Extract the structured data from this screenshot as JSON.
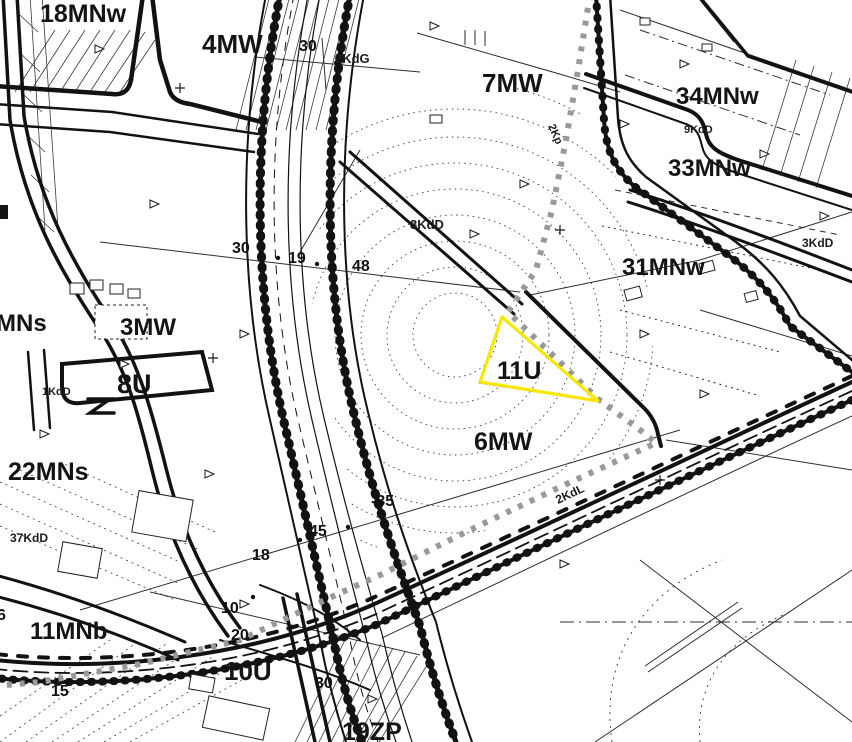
{
  "map": {
    "type": "zoning-plan-map",
    "colors": {
      "background": "#ffffff",
      "line_black": "#141414",
      "highlight_yellow": "#f8e800",
      "path_gray": "#999999"
    },
    "zone_labels": [
      {
        "text": "18MNw",
        "x": 40,
        "y": 22,
        "size": 25
      },
      {
        "text": "4MW",
        "x": 202,
        "y": 53,
        "size": 26
      },
      {
        "text": "7MW",
        "x": 482,
        "y": 92,
        "size": 26
      },
      {
        "text": "34MNw",
        "x": 676,
        "y": 104,
        "size": 24
      },
      {
        "text": "33MNw",
        "x": 668,
        "y": 176,
        "size": 24
      },
      {
        "text": "31MNw",
        "x": 622,
        "y": 275,
        "size": 24
      },
      {
        "text": "MNs",
        "x": -4,
        "y": 331,
        "size": 24
      },
      {
        "text": "3MW",
        "x": 120,
        "y": 335,
        "size": 24
      },
      {
        "text": "8U",
        "x": 117,
        "y": 393,
        "size": 27
      },
      {
        "text": "11U",
        "x": 497,
        "y": 379,
        "size": 25
      },
      {
        "text": "6MW",
        "x": 474,
        "y": 450,
        "size": 25
      },
      {
        "text": "22MNs",
        "x": 8,
        "y": 480,
        "size": 25
      },
      {
        "text": "11MNb",
        "x": 30,
        "y": 639,
        "size": 24
      },
      {
        "text": "10U",
        "x": 224,
        "y": 680,
        "size": 26
      },
      {
        "text": "19ZP",
        "x": 342,
        "y": 740,
        "size": 25
      }
    ],
    "road_labels": [
      {
        "text": "2KdG",
        "x": 335,
        "y": 63,
        "size": 13,
        "angle": 0
      },
      {
        "text": "2Kp",
        "x": 548,
        "y": 126,
        "size": 11,
        "angle": 66
      },
      {
        "text": "8KdD",
        "x": 410,
        "y": 229,
        "size": 13,
        "angle": 0
      },
      {
        "text": "9KdD",
        "x": 684,
        "y": 133,
        "size": 11,
        "angle": 0
      },
      {
        "text": "3KdD",
        "x": 802,
        "y": 247,
        "size": 12,
        "angle": 0
      },
      {
        "text": "1KdD",
        "x": 42,
        "y": 395,
        "size": 11,
        "angle": 0
      },
      {
        "text": "37KdD",
        "x": 10,
        "y": 542,
        "size": 12,
        "angle": 0
      },
      {
        "text": "2KdL",
        "x": 558,
        "y": 504,
        "size": 12,
        "angle": -25
      }
    ],
    "survey_numbers": [
      {
        "text": "30",
        "x": 299,
        "y": 51,
        "size": 16
      },
      {
        "text": "30",
        "x": 232,
        "y": 253,
        "size": 16
      },
      {
        "text": "19",
        "x": 288,
        "y": 263,
        "size": 16
      },
      {
        "text": "48",
        "x": 352,
        "y": 271,
        "size": 16
      },
      {
        "text": "-35",
        "x": 371,
        "y": 506,
        "size": 16
      },
      {
        "text": "45",
        "x": 309,
        "y": 536,
        "size": 16
      },
      {
        "text": "18",
        "x": 252,
        "y": 560,
        "size": 16
      },
      {
        "text": "10",
        "x": 221,
        "y": 613,
        "size": 16
      },
      {
        "text": "20",
        "x": 231,
        "y": 640,
        "size": 16
      },
      {
        "text": "6",
        "x": -3,
        "y": 620,
        "size": 16
      },
      {
        "text": "15",
        "x": 51,
        "y": 696,
        "size": 16
      },
      {
        "text": "30",
        "x": 315,
        "y": 688,
        "size": 16
      }
    ]
  }
}
